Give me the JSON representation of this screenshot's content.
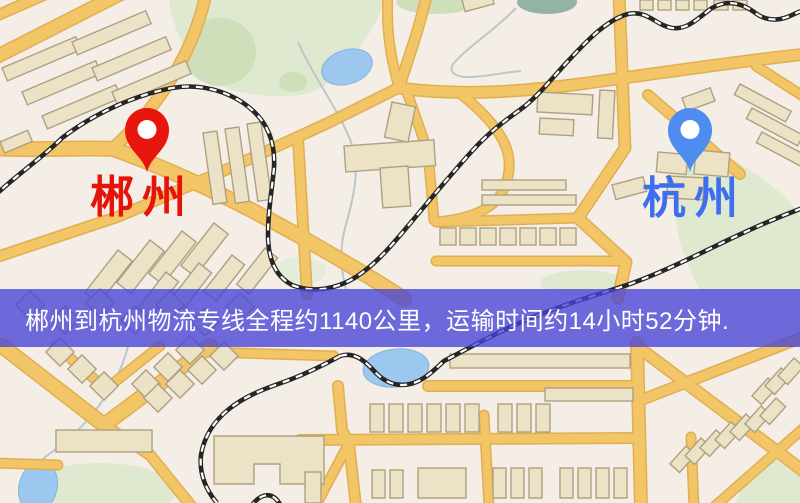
{
  "map": {
    "origin": {
      "label": "郴州",
      "pin_color": "#e8150c",
      "label_color": "#e41408"
    },
    "destination": {
      "label": "杭州",
      "pin_color": "#4f8cf0",
      "label_color": "#3e6ef0"
    }
  },
  "banner": {
    "text": "郴州到杭州物流专线全程约1140公里，运输时间约14小时52分钟.",
    "overlay_color": "rgba(70, 68, 215, 0.78)",
    "text_color": "#ffffff"
  },
  "map_colors": {
    "background": "#f4eee6",
    "road": "#f2c567",
    "road_border": "#e2ae52",
    "water": "#9cc7ee",
    "park": "#dfe9d0",
    "park_dark": "#cfdfba",
    "railway": "#262626",
    "building": "#ece2c6",
    "building_outline": "#ada083",
    "stream": "#bdc6cb"
  }
}
